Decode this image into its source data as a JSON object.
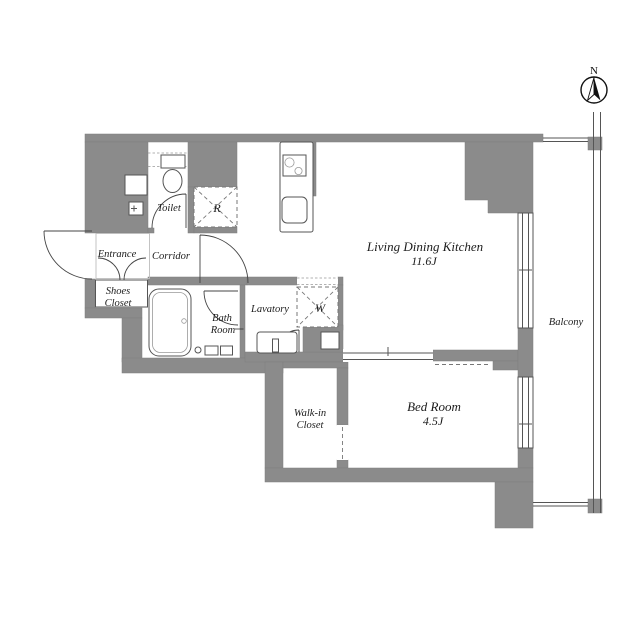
{
  "title": "Apartment floor plan",
  "colors": {
    "wall": "#8B8B8B",
    "fixture_line": "#555555",
    "text": "#1C1C1C",
    "light_line": "#BDBDBD",
    "background": "#FFFFFF"
  },
  "compass": {
    "label": "N"
  },
  "rooms": {
    "toilet": {
      "label": "Toilet"
    },
    "entrance": {
      "label": "Entrance"
    },
    "corridor": {
      "label": "Corridor"
    },
    "shoes_closet": {
      "line1": "Shoes",
      "line2": "Closet"
    },
    "bath_room": {
      "line1": "Bath",
      "line2": "Room"
    },
    "lavatory": {
      "label": "Lavatory"
    },
    "walk_in_closet": {
      "line1": "Walk-in",
      "line2": "Closet"
    },
    "ldk": {
      "label": "Living Dining Kitchen",
      "size": "11.6J"
    },
    "bed_room": {
      "label": "Bed Room",
      "size": "4.5J"
    },
    "balcony": {
      "label": "Balcony"
    }
  },
  "fixtures": {
    "refrigerator": {
      "label": "R"
    },
    "washing_machine": {
      "label": "W"
    }
  }
}
